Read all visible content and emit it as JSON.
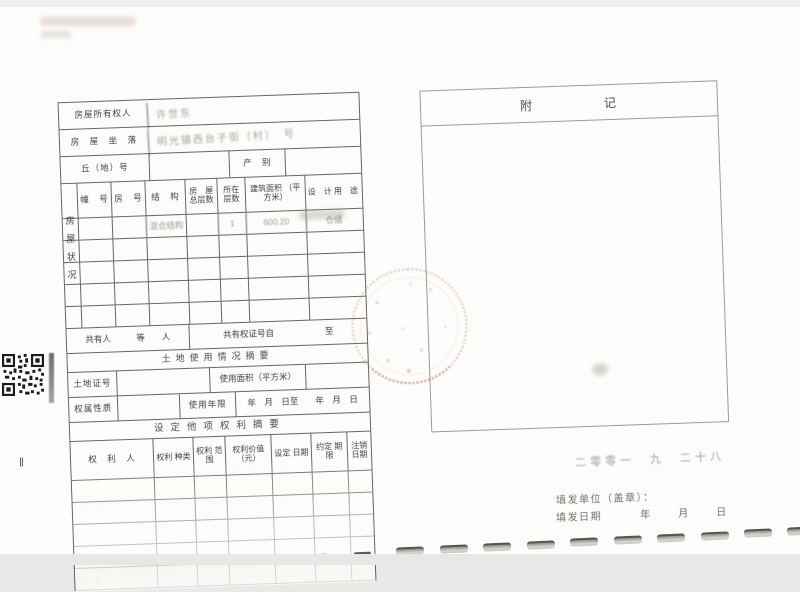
{
  "colors": {
    "backdrop": "#e9e9e7",
    "page_bg": "#fcfcfa",
    "table_line": "#3e3c3a",
    "seal_red": "#ba7666"
  },
  "form": {
    "owner": {
      "label": "房屋所有权人",
      "value": "许世东"
    },
    "location": {
      "label": "房　屋　坐　落",
      "value": "明光镇西台子街（村）　号"
    },
    "plot": {
      "label": "丘（地）号",
      "value": "",
      "category_label": "产　别",
      "category_value": ""
    },
    "status_vertical_label": "房屋状况",
    "housing_table": {
      "columns": [
        "幢　号",
        "房　号",
        "结　构",
        "房　屋 总层数",
        "所在 层数",
        "建筑面积 （平方米）",
        "设　计 用　途"
      ],
      "first_row": {
        "unit": "",
        "room": "",
        "structure": "混合结构",
        "total_floors": "",
        "floor": "1",
        "area": "600.20",
        "usage": "仓储"
      }
    },
    "co_owner_row": {
      "left": "共有人　　　等　　人",
      "right": "共有权证号自　　　　　　至"
    },
    "land_section_title": "土地使用情况摘要",
    "land_row": {
      "label": "土地证号",
      "area_label": "使用面积（平方米）"
    },
    "tenure_row": {
      "label": "权属性质",
      "years_label": "使用年限",
      "dates": "年　月　日至　　年　月　日"
    },
    "rights_section_title": "设定他项权利摘要",
    "rights_table_columns": [
      "权　利　人",
      "权利 种类",
      "权利 范围",
      "权利价值 （元）",
      "设定 日期",
      "约定 期限",
      "注销 日期"
    ]
  },
  "annex": {
    "title": "附　　　　　记"
  },
  "issue": {
    "handwritten_date": "二零零一　九　二十八",
    "unit_label": "填发单位（盖章）：",
    "date_label": "填发日期",
    "date_blanks": "年　月　日"
  },
  "page_marker": "Ⅱ",
  "icons": {
    "qr_code": "qr-code",
    "seal": "round-red-official-seal-faded",
    "binder_holes": "booklet-binding-holes"
  }
}
